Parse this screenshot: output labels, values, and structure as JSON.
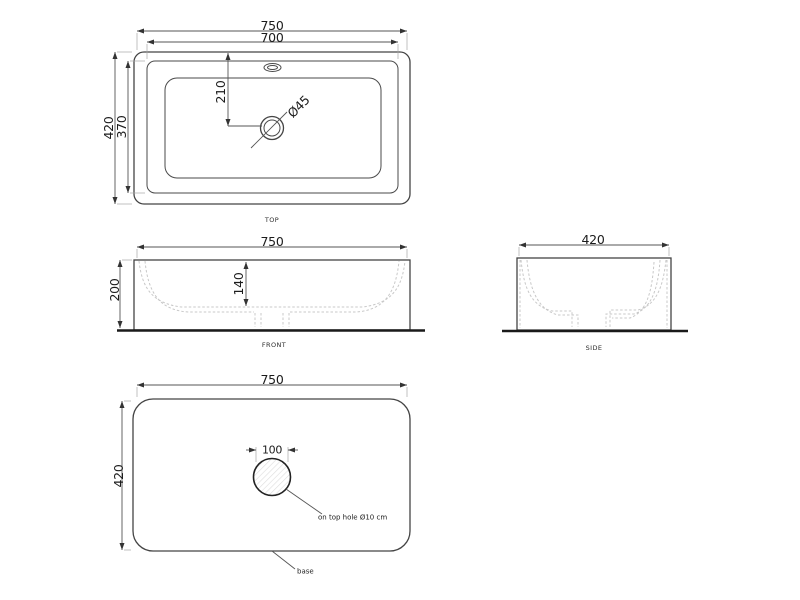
{
  "views": {
    "top": {
      "label": "TOP",
      "dims": {
        "outer_width": "750",
        "inner_width": "700",
        "outer_depth": "420",
        "inner_depth": "370",
        "drain_offset": "210",
        "drain_diameter": "Ø45"
      }
    },
    "front": {
      "label": "FRONT",
      "dims": {
        "width": "750",
        "height": "200",
        "bowl_depth": "140"
      }
    },
    "side": {
      "label": "SIDE",
      "dims": {
        "depth": "420"
      }
    },
    "bottom": {
      "leader_label": "base",
      "note": "on top hole Ø10 cm",
      "dims": {
        "width": "750",
        "depth": "420",
        "hole_width": "100"
      }
    }
  },
  "colors": {
    "background": "#ffffff",
    "line": "#444444",
    "hidden_line": "#c8c8c8",
    "ground_line": "#1a1a1a",
    "text": "#1c1c1c"
  }
}
